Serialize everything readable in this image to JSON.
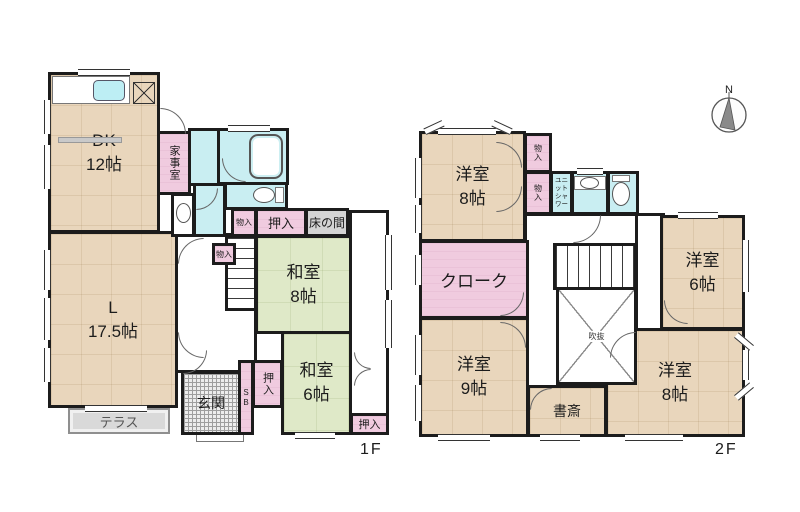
{
  "floor1": {
    "floor_label": "1F",
    "rooms": {
      "dk": {
        "name": "DK",
        "size": "12帖"
      },
      "living": {
        "name": "L",
        "size": "17.5帖"
      },
      "washitsu8": {
        "name": "和室",
        "size": "8帖"
      },
      "washitsu6": {
        "name": "和室",
        "size": "6帖"
      },
      "kajishitsu": "家事室",
      "oshiire_top": "押入",
      "tokonoma": "床の間",
      "monoire_a": "物入",
      "monoire_b": "物入",
      "oshiire_side": "押入",
      "sb": "SB",
      "genkan": "玄関",
      "terrace": "テラス",
      "oshiire_br": "押入"
    }
  },
  "floor2": {
    "floor_label": "2F",
    "rooms": {
      "yoshitsu8_nw": {
        "name": "洋室",
        "size": "8帖"
      },
      "yoshitsu6": {
        "name": "洋室",
        "size": "6帖"
      },
      "yoshitsu9": {
        "name": "洋室",
        "size": "9帖"
      },
      "yoshitsu8_se": {
        "name": "洋室",
        "size": "8帖"
      },
      "cloak": "クローク",
      "monoire_a": "物入",
      "monoire_b": "物入",
      "unit_shower": {
        "line1": "ユニット",
        "line2": "シャワー"
      },
      "shosai": "書斎",
      "fukinuke": "吹抜"
    }
  },
  "compass": {
    "north": "N"
  },
  "colors": {
    "wall": "#1c1c1c",
    "wood_floor": "#e9d6bc",
    "tatami": "#dfe9c8",
    "closet_pink": "#f0cbdf",
    "wet_cyan": "#c9eef2",
    "tokonoma_gray": "#d4d4d4"
  }
}
